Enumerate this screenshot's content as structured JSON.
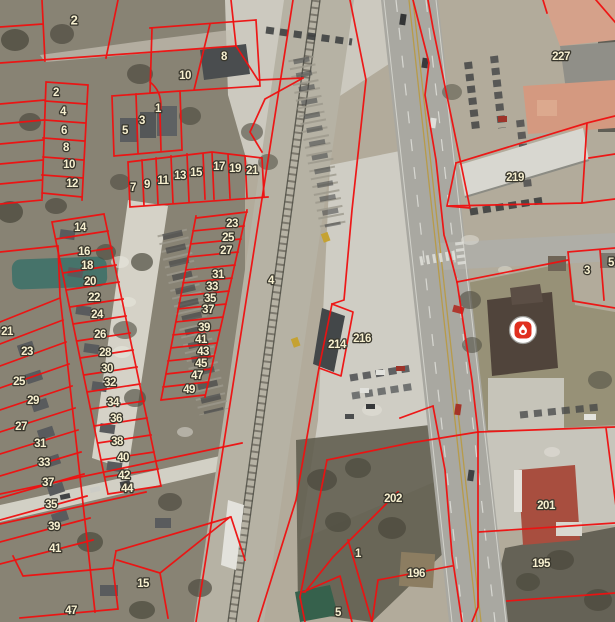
{
  "map": {
    "colors": {
      "parcel_line": "#ee1111",
      "label_text": "#f6efcf",
      "label_halo": "#38362c",
      "marker_red": "#e03020",
      "marker_ring": "#ffffff"
    },
    "poi_marker": {
      "icon": "fire-station-marker",
      "x": 523,
      "y": 330
    },
    "labels": [
      {
        "t": "2",
        "x": 74,
        "y": 20,
        "s": 13
      },
      {
        "t": "2",
        "x": 56,
        "y": 93
      },
      {
        "t": "4",
        "x": 63,
        "y": 112
      },
      {
        "t": "6",
        "x": 64,
        "y": 131
      },
      {
        "t": "8",
        "x": 66,
        "y": 148
      },
      {
        "t": "10",
        "x": 69,
        "y": 165
      },
      {
        "t": "12",
        "x": 72,
        "y": 184
      },
      {
        "t": "8",
        "x": 224,
        "y": 57
      },
      {
        "t": "10",
        "x": 185,
        "y": 76
      },
      {
        "t": "1",
        "x": 158,
        "y": 109
      },
      {
        "t": "3",
        "x": 142,
        "y": 121
      },
      {
        "t": "5",
        "x": 125,
        "y": 131
      },
      {
        "t": "7",
        "x": 133,
        "y": 188
      },
      {
        "t": "9",
        "x": 147,
        "y": 185
      },
      {
        "t": "11",
        "x": 163,
        "y": 181
      },
      {
        "t": "13",
        "x": 180,
        "y": 176
      },
      {
        "t": "15",
        "x": 196,
        "y": 173
      },
      {
        "t": "17",
        "x": 219,
        "y": 167
      },
      {
        "t": "19",
        "x": 235,
        "y": 169
      },
      {
        "t": "21",
        "x": 252,
        "y": 171
      },
      {
        "t": "14",
        "x": 80,
        "y": 228
      },
      {
        "t": "16",
        "x": 84,
        "y": 252
      },
      {
        "t": "18",
        "x": 87,
        "y": 266
      },
      {
        "t": "20",
        "x": 90,
        "y": 282
      },
      {
        "t": "22",
        "x": 94,
        "y": 298
      },
      {
        "t": "24",
        "x": 97,
        "y": 315
      },
      {
        "t": "26",
        "x": 100,
        "y": 335
      },
      {
        "t": "28",
        "x": 105,
        "y": 353
      },
      {
        "t": "30",
        "x": 107,
        "y": 369
      },
      {
        "t": "32",
        "x": 110,
        "y": 383
      },
      {
        "t": "34",
        "x": 113,
        "y": 403
      },
      {
        "t": "36",
        "x": 116,
        "y": 419
      },
      {
        "t": "38",
        "x": 117,
        "y": 442
      },
      {
        "t": "40",
        "x": 123,
        "y": 458
      },
      {
        "t": "42",
        "x": 124,
        "y": 476
      },
      {
        "t": "44",
        "x": 127,
        "y": 489
      },
      {
        "t": "21",
        "x": 7,
        "y": 332
      },
      {
        "t": "23",
        "x": 27,
        "y": 352
      },
      {
        "t": "25",
        "x": 19,
        "y": 382
      },
      {
        "t": "29",
        "x": 33,
        "y": 401
      },
      {
        "t": "27",
        "x": 21,
        "y": 427
      },
      {
        "t": "31",
        "x": 40,
        "y": 444
      },
      {
        "t": "33",
        "x": 44,
        "y": 463
      },
      {
        "t": "37",
        "x": 48,
        "y": 483
      },
      {
        "t": "35",
        "x": 51,
        "y": 505
      },
      {
        "t": "39",
        "x": 54,
        "y": 527
      },
      {
        "t": "41",
        "x": 55,
        "y": 549
      },
      {
        "t": "47",
        "x": 71,
        "y": 611
      },
      {
        "t": "15",
        "x": 143,
        "y": 584
      },
      {
        "t": "23",
        "x": 232,
        "y": 224
      },
      {
        "t": "25",
        "x": 228,
        "y": 238
      },
      {
        "t": "27",
        "x": 226,
        "y": 251
      },
      {
        "t": "31",
        "x": 218,
        "y": 275
      },
      {
        "t": "33",
        "x": 212,
        "y": 287
      },
      {
        "t": "35",
        "x": 210,
        "y": 299
      },
      {
        "t": "37",
        "x": 208,
        "y": 310
      },
      {
        "t": "39",
        "x": 204,
        "y": 328
      },
      {
        "t": "41",
        "x": 201,
        "y": 340
      },
      {
        "t": "43",
        "x": 203,
        "y": 352
      },
      {
        "t": "45",
        "x": 201,
        "y": 364
      },
      {
        "t": "47",
        "x": 197,
        "y": 376
      },
      {
        "t": "49",
        "x": 189,
        "y": 390
      },
      {
        "t": "4",
        "x": 271,
        "y": 281
      },
      {
        "t": "214",
        "x": 337,
        "y": 345
      },
      {
        "t": "216",
        "x": 362,
        "y": 339
      },
      {
        "t": "227",
        "x": 561,
        "y": 57
      },
      {
        "t": "219",
        "x": 515,
        "y": 178
      },
      {
        "t": "3",
        "x": 587,
        "y": 271
      },
      {
        "t": "5",
        "x": 611,
        "y": 263
      },
      {
        "t": "202",
        "x": 393,
        "y": 499
      },
      {
        "t": "1",
        "x": 358,
        "y": 554
      },
      {
        "t": "5",
        "x": 338,
        "y": 613
      },
      {
        "t": "196",
        "x": 416,
        "y": 574
      },
      {
        "t": "201",
        "x": 546,
        "y": 506
      },
      {
        "t": "195",
        "x": 541,
        "y": 564
      }
    ]
  }
}
